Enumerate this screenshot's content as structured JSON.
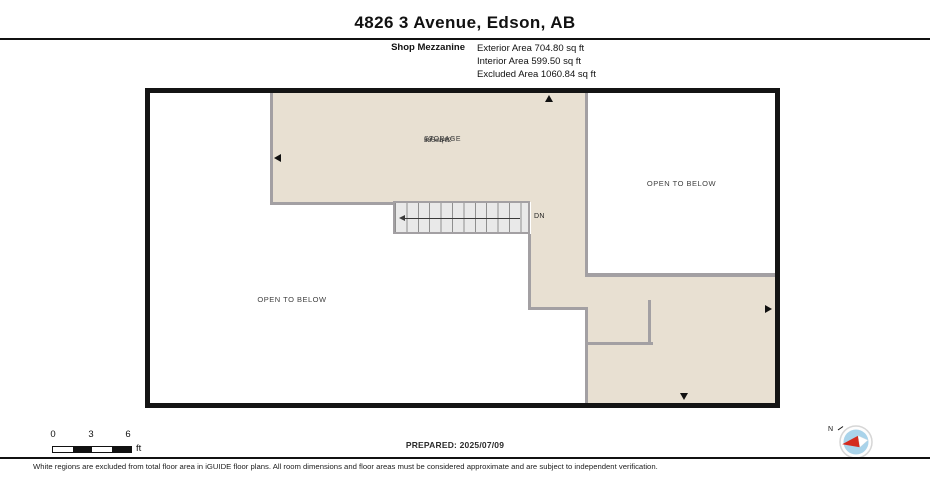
{
  "header": {
    "title": "4826 3 Avenue, Edson, AB",
    "floor_name": "Shop Mezzanine",
    "area_lines": [
      "Exterior Area 704.80 sq ft",
      "Interior Area 599.50 sq ft",
      "Excluded Area 1060.84 sq ft"
    ]
  },
  "plan": {
    "storage": {
      "name": "STORAGE",
      "dimensions": "39' x 34'2\"",
      "area": "535 sq ft"
    },
    "open_to_below_left": "OPEN TO BELOW",
    "open_to_below_right": "OPEN TO BELOW",
    "stair_direction": "DN"
  },
  "scale_bar": {
    "ticks": [
      "0",
      "3",
      "6"
    ],
    "unit": "ft"
  },
  "prepared": "PREPARED: 2025/07/09",
  "compass": {
    "north": "N"
  },
  "disclaimer": "White regions are excluded from total floor area in iGUIDE floor plans. All room dimensions and floor areas must be considered approximate and are subject to independent verification.",
  "colors": {
    "floor_fill": "#e8e0d2",
    "wall_gray": "#a3a0a3",
    "stair_fill": "#e9e9e9",
    "border_black": "#141414",
    "compass_blue": "#a9d3ea",
    "compass_red": "#d42b1e"
  }
}
